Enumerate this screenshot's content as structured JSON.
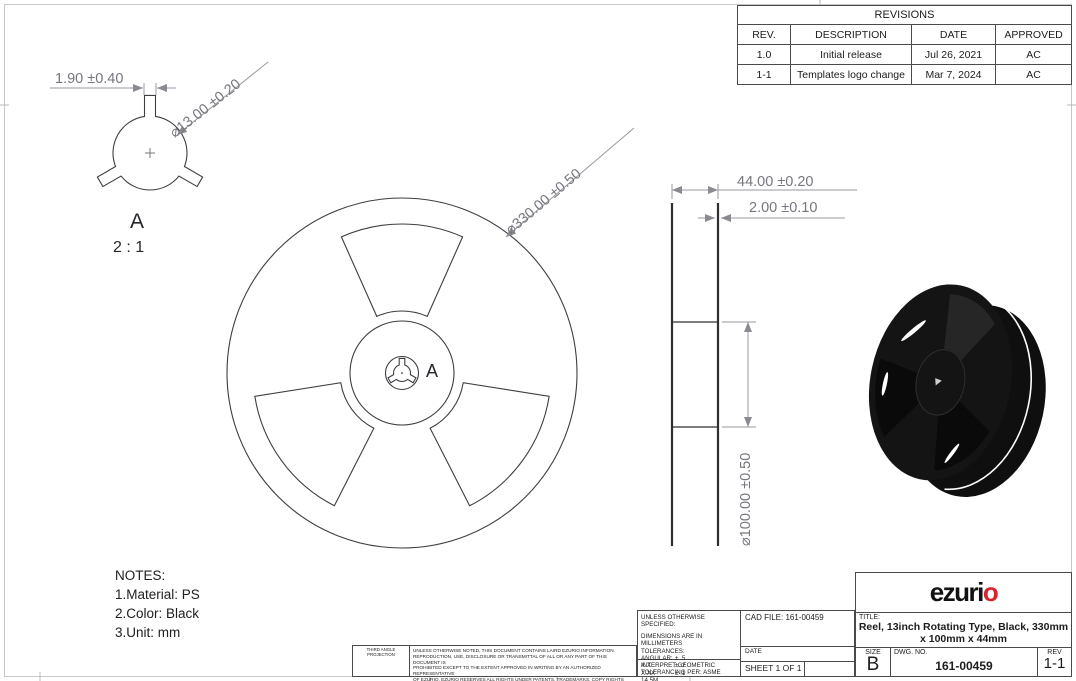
{
  "revisions": {
    "title": "REVISIONS",
    "headers": {
      "rev": "REV.",
      "description": "DESCRIPTION",
      "date": "DATE",
      "approved": "APPROVED"
    },
    "rows": [
      {
        "rev": "1.0",
        "description": "Initial release",
        "date": "Jul 26, 2021",
        "approved": "AC"
      },
      {
        "rev": "1-1",
        "description": "Templates logo change",
        "date": "Mar 7, 2024",
        "approved": "AC"
      }
    ]
  },
  "detail_view": {
    "dim_tab_width": "1.90 ±0.40",
    "dim_hole_dia": "⌀13.00 ±0.20",
    "label": "A",
    "scale": "2 : 1"
  },
  "front_view": {
    "dim_outer_dia": "⌀330.00 ±0.50",
    "detail_callout": "A"
  },
  "side_view": {
    "dim_width": "44.00 ±0.20",
    "dim_flange_thickness": "2.00 ±0.10",
    "dim_hub_dia": "⌀100.00 ±0.50"
  },
  "notes": {
    "title": "NOTES:",
    "items": [
      "1.Material: PS",
      "2.Color: Black",
      "3.Unit: mm"
    ]
  },
  "title_block": {
    "logo_black": "ezuri",
    "logo_red": "o",
    "title_label": "TITLE:",
    "title_line1": "Reel, 13inch Rotating Type, Black, 330mm",
    "title_line2": "x 100mm x 44mm",
    "size_label": "SIZE",
    "size_value": "B",
    "dwg_label": "DWG.  NO.",
    "dwg_value": "161-00459",
    "rev_label": "REV",
    "rev_value": "1-1",
    "logo_red_hex": "#d8232a"
  },
  "spec_block": {
    "line1": "UNLESS OTHERWISE SPECIFIED:",
    "line2": "DIMENSIONS ARE IN MILLIMETERS",
    "line3": "TOLERANCES:",
    "tol_rows": [
      {
        "label": "ANGULAR:",
        "value": "± .5"
      },
      {
        "label": "X.X",
        "value": "± .2"
      },
      {
        "label": "X.XX",
        "value": "± .1"
      }
    ],
    "interpret_line1": "INTERPRET GEOMETRIC",
    "interpret_line2": "TOLERANCING PER:  ASME 14.5M",
    "cad_file": "CAD FILE: 161-00459",
    "date_label": "DATE",
    "sheet": "SHEET 1 OF 1"
  },
  "projection_block": {
    "label": "THIRD ANGLE PROJECTION",
    "legal_lines": [
      "UNLESS OTHERWISE NOTED, THIS DOCUMENT CONTAINS LAIRD EZURIO INFORMATION.",
      "REPRODUCTION, USE, DISCLOSURE OR TRANSMITTAL OF ALL OR ANY PART OF THIS DOCUMENT IS",
      "PROHIBITED EXCEPT TO THE EXTENT APPROVED IN WRITING BY AN AUTHORIZED REPRESENTATIVE",
      "OF EZURIO. EZURIO RESERVES ALL RIGHTS UNDER PATENTS, TRADEMARKS, COPY RIGHTS AND",
      "TRADE SECRETS. COPYRIGHT, EZURIO  2024, ALL RIGHTS RESERVED."
    ]
  }
}
